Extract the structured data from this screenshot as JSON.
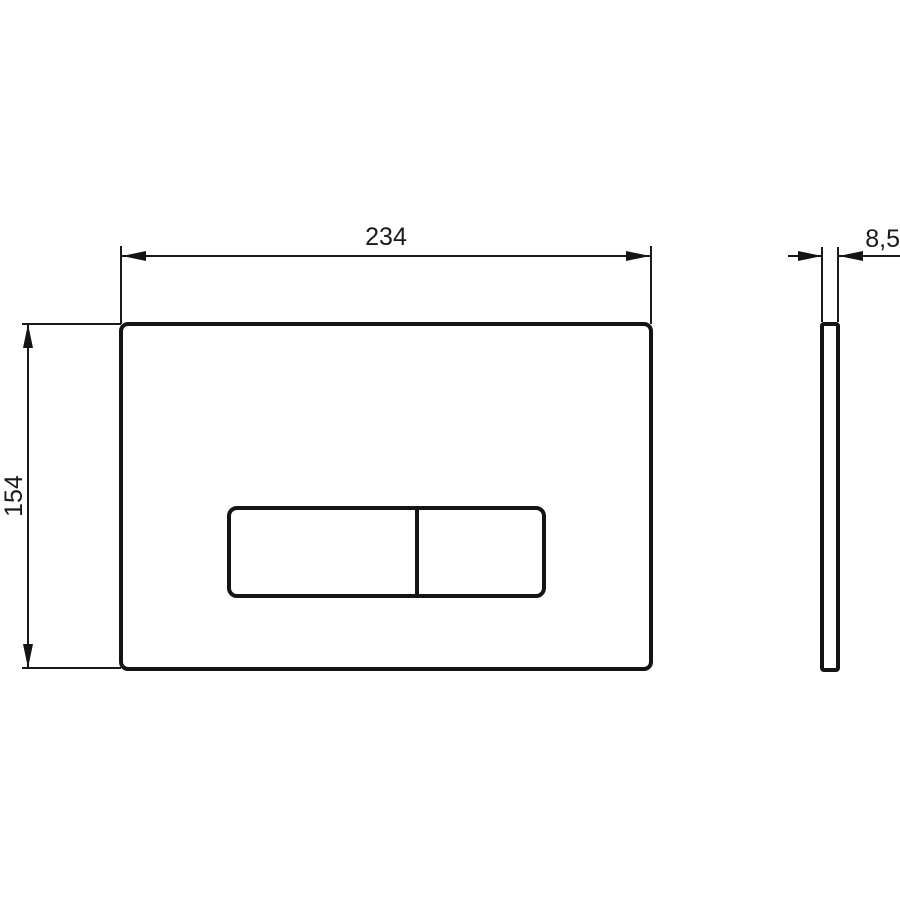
{
  "drawing": {
    "type": "technical-dimension-drawing",
    "subject": "dual-flush actuator plate, front view and side profile",
    "colors": {
      "line": "#141414",
      "background": "#ffffff"
    },
    "dimensions": {
      "width": {
        "value": "234",
        "orientation": "horizontal-top"
      },
      "height": {
        "value": "154",
        "orientation": "vertical-left-rotated"
      },
      "depth": {
        "value": "8,5",
        "orientation": "horizontal-top-right"
      }
    }
  }
}
